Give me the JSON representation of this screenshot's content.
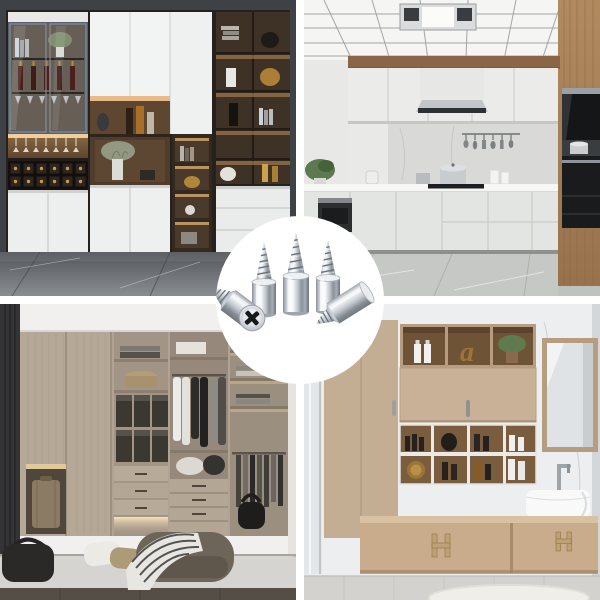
{
  "meta": {
    "kind": "product lifestyle collage",
    "grid": "2x2 photos with white dividers and round center product inset",
    "divider_color": "#ffffff"
  },
  "product": {
    "label": "Five chrome screw-in cabinet shelf support pegs shown in a white circular inset",
    "item_count": 5,
    "finish": "polished chrome",
    "metal_color": "#c6ccd2",
    "drive_type": "phillips cross head",
    "inset_background": "#ffffff"
  },
  "panels": {
    "top_left": {
      "label": "Dark living room wall unit with glass wine cabinet, lattice bottle rack, lit wood shelves and white doors on grey marble floor",
      "wall_color": "#3e4145",
      "wood_color": "#5e4631",
      "door_color": "#eef0ef",
      "floor_color": "#84878c"
    },
    "top_right": {
      "label": "White U-shaped kitchen with aluminum grid ceiling, range hood, marble backsplash, oak tall cabinets and built-in black ovens",
      "cabinet_color": "#ebebe9",
      "wood_color": "#a8835c",
      "appliance_color": "#151618",
      "floor_color": "#c6c8c6"
    },
    "bottom_left": {
      "label": "Greige walk-in closet with open shelving, hanging clothes, drawers, lit suitcase niche, ottoman and striped throw on a grey rug",
      "cabinet_color": "#b5a897",
      "box_color": "#3b3731",
      "rug_color": "#d6d4d0"
    },
    "bottom_right": {
      "label": "Bathroom with floating tan vanity, white vessel sink, framed mirror and open cubby shelves on marble wall",
      "cabinet_color": "#c9ac8b",
      "wood_color": "#7a5c3f",
      "wall_color": "#eceef0",
      "decor_letter": "a",
      "handle_color": "#bfa176"
    }
  }
}
